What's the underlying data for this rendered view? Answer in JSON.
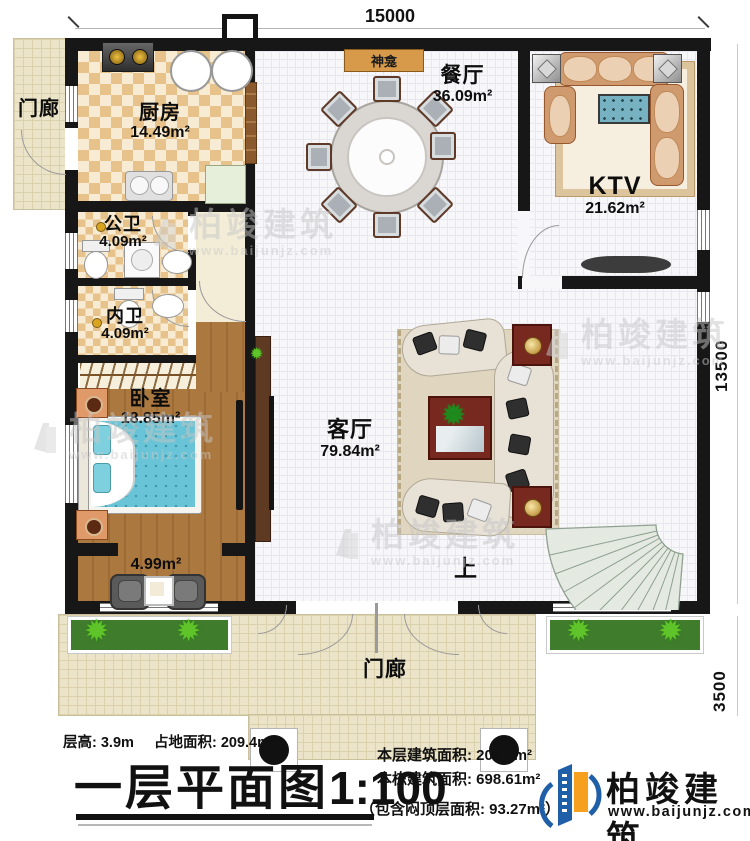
{
  "dimensions": {
    "top": "15000",
    "right_upper": "13500",
    "right_lower": "3500"
  },
  "rooms": {
    "porch_left": {
      "name": "门廊"
    },
    "kitchen": {
      "name": "厨房",
      "area": "14.49m²"
    },
    "public_bath": {
      "name": "公卫",
      "area": "4.09m²"
    },
    "inner_bath": {
      "name": "内卫",
      "area": "4.09m²"
    },
    "bedroom": {
      "name": "卧室",
      "area": "18.85m²"
    },
    "balcony": {
      "area": "4.99m²"
    },
    "shrine": {
      "name": "神龛"
    },
    "dining": {
      "name": "餐厅",
      "area": "36.09m²"
    },
    "ktv": {
      "name": "KTV",
      "area": "21.62m²"
    },
    "living": {
      "name": "客厅",
      "area": "79.84m²"
    },
    "stair": {
      "label": "上"
    },
    "porch_bottom": {
      "name": "门廊"
    }
  },
  "footer": {
    "floor_height": "层高: 3.9m",
    "footprint": "占地面积: 209.4m²",
    "title": "一层平面图",
    "scale": "1:100",
    "floor_area": "本层建筑面积: 209.4m²",
    "building_area": "本栋建筑面积: 698.61m²",
    "attic_note": "（包含闷顶层面积: 93.27m²）"
  },
  "brand": {
    "name": "柏竣建筑",
    "url": "www.baijunjz.com"
  },
  "colors": {
    "wall": "#171717",
    "brand_blue": "#1f5fa8",
    "brand_orange": "#f6a01d",
    "wood": "#ab7840",
    "checker": "#e7c38b",
    "porch": "#ece4c8",
    "green": "#3f7d2d"
  }
}
